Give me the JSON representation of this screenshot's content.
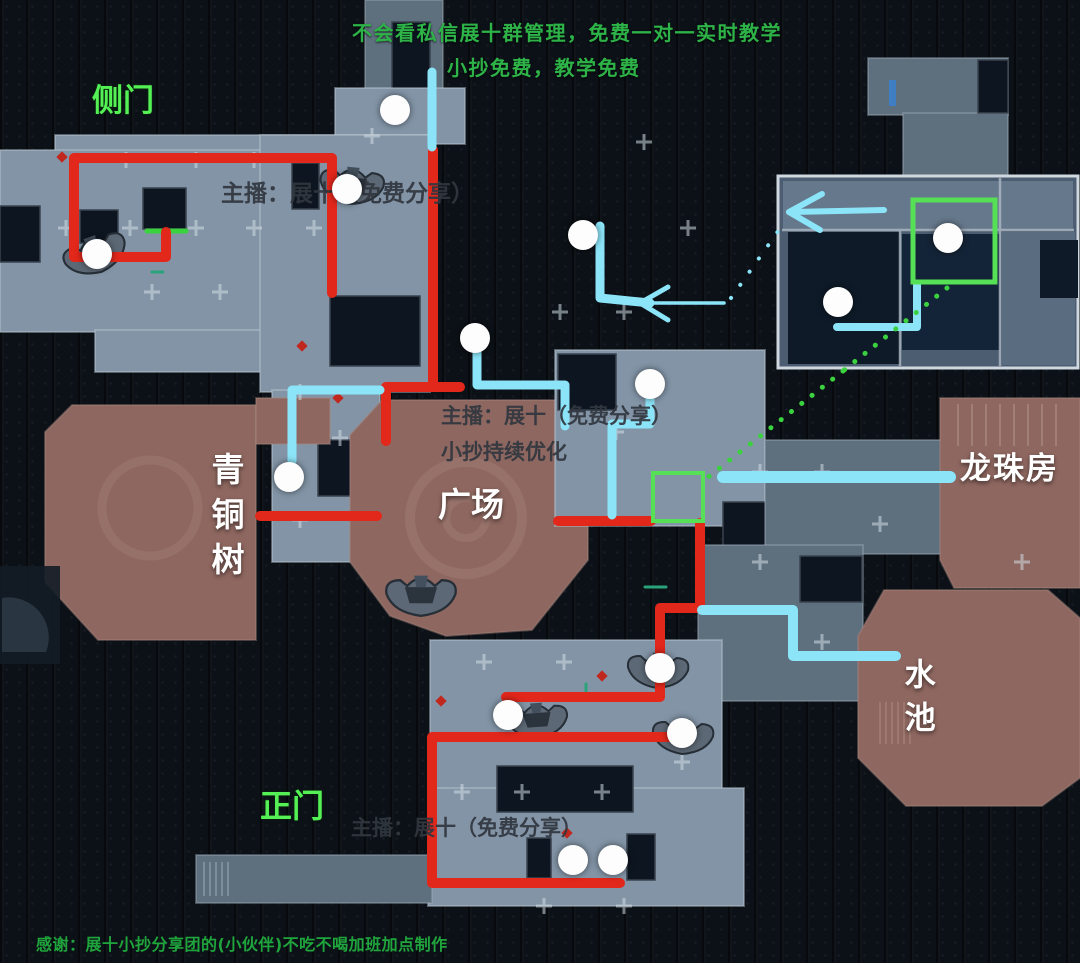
{
  "annotations": {
    "promo_line1": "不会看私信展十群管理，免费一对一实时教学",
    "promo_line2": "小抄免费，教学免费",
    "side_door": "侧门",
    "streamer_top": "主播：展十（免费分享）",
    "bronze_tree": "青铜树",
    "plaza": "广场",
    "streamer_mid_line1": "主播：展十（免费分享）",
    "streamer_mid_line2": "小抄持续优化",
    "dragon_ball_room": "龙珠房",
    "pool": "水池",
    "main_gate": "正门",
    "streamer_bottom": "主播：展十（免费分享）",
    "credits": "感谢：展十小抄分享团的(小伙伴)不吃不喝加班加点制作"
  },
  "colors": {
    "promo_green": "#2db347",
    "label_green": "#55f055",
    "credits_green": "#1fa53c",
    "streamer_gray": "#32373e",
    "white_label": "#ffffff",
    "route_red": "#e2271b",
    "route_cyan": "#8ce4f8",
    "box_green": "#55e055",
    "dotted_green": "#3bd23f",
    "decor_red": "#c0271d",
    "decor_teal": "#2aa37a",
    "door_blue": "#3f7ec2"
  },
  "map": {
    "routes_red": [
      {
        "points": [
          [
            166,
            232
          ],
          [
            166,
            257
          ],
          [
            74,
            257
          ],
          [
            74,
            158
          ],
          [
            332,
            158
          ],
          [
            332,
            293
          ]
        ]
      },
      {
        "points": [
          [
            433,
            150
          ],
          [
            433,
            387
          ]
        ]
      },
      {
        "points": [
          [
            386,
            441
          ],
          [
            386,
            387
          ],
          [
            460,
            387
          ]
        ]
      },
      {
        "points": [
          [
            260,
            516
          ],
          [
            377,
            516
          ]
        ]
      },
      {
        "points": [
          [
            558,
            521
          ],
          [
            651,
            521
          ]
        ]
      },
      {
        "points": [
          [
            700,
            523
          ],
          [
            700,
            608
          ],
          [
            660,
            608
          ],
          [
            660,
            697
          ],
          [
            506,
            697
          ]
        ]
      },
      {
        "points": [
          [
            672,
            737
          ],
          [
            432,
            737
          ],
          [
            432,
            883
          ],
          [
            620,
            883
          ]
        ]
      }
    ],
    "routes_cyan": [
      {
        "points": [
          [
            432,
            72
          ],
          [
            432,
            147
          ]
        ],
        "width": 9
      },
      {
        "points": [
          [
            600,
            226
          ],
          [
            600,
            298
          ],
          [
            650,
            303
          ]
        ],
        "width": 9
      },
      {
        "points": [
          [
            648,
            303
          ],
          [
            724,
            303
          ]
        ],
        "width": 3.5
      },
      {
        "points": [
          [
            640,
            303
          ],
          [
            668,
            287
          ]
        ],
        "width": 5
      },
      {
        "points": [
          [
            640,
            303
          ],
          [
            668,
            320
          ]
        ],
        "width": 5
      },
      {
        "points": [
          [
            380,
            390
          ],
          [
            292,
            390
          ],
          [
            292,
            461
          ]
        ],
        "width": 9
      },
      {
        "points": [
          [
            477,
            352
          ],
          [
            477,
            385
          ],
          [
            565,
            385
          ],
          [
            565,
            426
          ]
        ],
        "width": 9
      },
      {
        "points": [
          [
            650,
            399
          ],
          [
            650,
            424
          ],
          [
            612,
            424
          ],
          [
            612,
            515
          ]
        ],
        "width": 9
      },
      {
        "points": [
          [
            723,
            477
          ],
          [
            950,
            477
          ]
        ],
        "width": 12
      },
      {
        "points": [
          [
            702,
            610
          ],
          [
            793,
            610
          ],
          [
            793,
            656
          ],
          [
            896,
            656
          ]
        ],
        "width": 10
      },
      {
        "points": [
          [
            917,
            284
          ],
          [
            917,
            327
          ],
          [
            837,
            327
          ]
        ],
        "width": 8
      },
      {
        "points": [
          [
            884,
            210
          ],
          [
            792,
            212
          ]
        ],
        "width": 6
      },
      {
        "points": [
          [
            789,
            212
          ],
          [
            822,
            194
          ]
        ],
        "width": 6
      },
      {
        "points": [
          [
            789,
            212
          ],
          [
            820,
            230
          ]
        ],
        "width": 6
      }
    ],
    "start_tick": {
      "points": [
        [
          147,
          231
        ],
        [
          186,
          231
        ]
      ]
    },
    "green_boxes": [
      {
        "x": 913,
        "y": 200,
        "w": 82,
        "h": 82,
        "stroke": 5
      },
      {
        "x": 653,
        "y": 473,
        "w": 50,
        "h": 48,
        "stroke": 4
      }
    ],
    "dotted_green": [
      {
        "from": [
          947,
          288
        ],
        "to": [
          843,
          371
        ]
      },
      {
        "from": [
          843,
          371
        ],
        "to": [
          707,
          478
        ]
      }
    ],
    "dotted_cyan": [
      {
        "from": [
          731,
          298
        ],
        "to": [
          786,
          220
        ]
      }
    ],
    "markers": [
      [
        395,
        110
      ],
      [
        347,
        189
      ],
      [
        97,
        254
      ],
      [
        583,
        235
      ],
      [
        948,
        238
      ],
      [
        838,
        302
      ],
      [
        475,
        338
      ],
      [
        650,
        384
      ],
      [
        289,
        477
      ],
      [
        660,
        668
      ],
      [
        508,
        715
      ],
      [
        682,
        733
      ],
      [
        573,
        860
      ],
      [
        613,
        860
      ]
    ],
    "boats": [
      {
        "x": 95,
        "y": 253,
        "rot": -20,
        "s": 1.05
      },
      {
        "x": 352,
        "y": 184,
        "rot": 5,
        "s": 1.05
      },
      {
        "x": 421,
        "y": 594,
        "rot": 0,
        "s": 1.15
      },
      {
        "x": 658,
        "y": 669,
        "rot": 3,
        "s": 1.0
      },
      {
        "x": 537,
        "y": 719,
        "rot": -4,
        "s": 1.0
      },
      {
        "x": 683,
        "y": 735,
        "rot": 3,
        "s": 1.0
      }
    ],
    "decor_red_marks": [
      [
        62,
        157
      ],
      [
        302,
        346
      ],
      [
        338,
        398
      ],
      [
        602,
        676
      ],
      [
        441,
        701
      ],
      [
        567,
        833
      ]
    ],
    "decor_teal_marks": [
      {
        "points": [
          [
            645,
            587
          ],
          [
            666,
            587
          ]
        ]
      },
      {
        "points": [
          [
            586,
            684
          ],
          [
            586,
            698
          ]
        ]
      },
      {
        "points": [
          [
            152,
            272
          ],
          [
            163,
            272
          ]
        ]
      }
    ]
  }
}
